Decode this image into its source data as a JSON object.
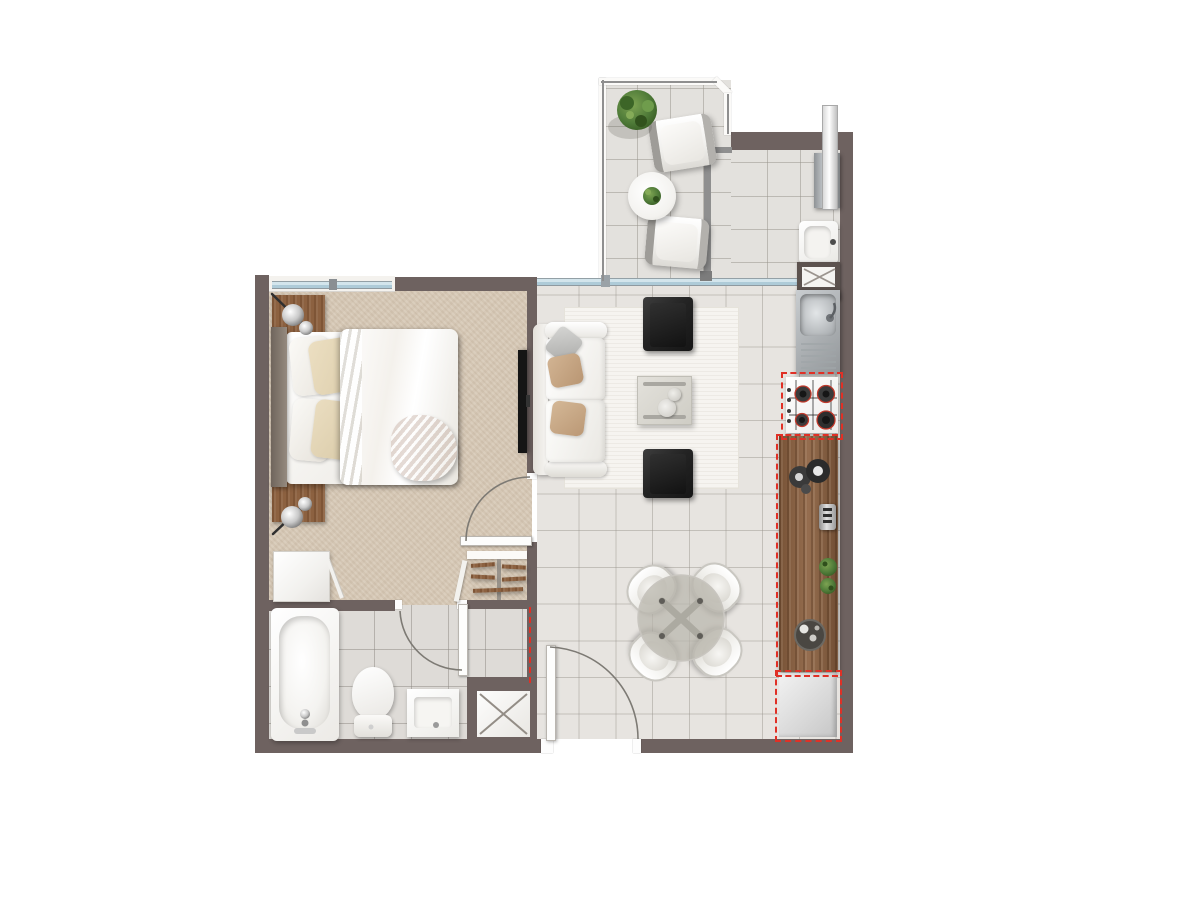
{
  "scene": {
    "type": "apartment-floor-plan",
    "visible_text": "none",
    "rooms": [
      {
        "name": "bedroom"
      },
      {
        "name": "bathroom"
      },
      {
        "name": "living-dining-room"
      },
      {
        "name": "kitchen-strip"
      },
      {
        "name": "balcony-terrace"
      },
      {
        "name": "laundry-terrace"
      },
      {
        "name": "hall-nook"
      }
    ],
    "furniture": [
      "double-bed",
      "nightstand-with-lamp-x2",
      "dresser",
      "open-closet-with-hangers",
      "wall-tv",
      "sofa",
      "armchair-black-x2",
      "coffee-table",
      "rug",
      "dining-table-round-glass",
      "dining-chair-x4",
      "bathtub",
      "toilet",
      "washbasin",
      "duct-shaft",
      "kitchen-sink-with-drainboard",
      "gas-cooktop-4-burner",
      "wood-counter",
      "fridge-space-dashed",
      "laundry-sink",
      "water-heater",
      "appliance-space-crosshatch",
      "balcony-lounge-chair-x2",
      "balcony-round-table",
      "potted-plant"
    ],
    "markers": {
      "red_dashed_outlines": "optional / not-included equipment and openings",
      "door_swing_arcs": 3
    }
  },
  "colors": {
    "wall": "#6e6260",
    "wall_dark": "#5c524e",
    "carpet": "#d7c9b6",
    "tile_living": "#e7e4e0",
    "tile_bath": "#dedbd7",
    "tile_balcony": "#e3e1dd",
    "wood": "#8c6140",
    "rail_gray": "#8f8f8f",
    "red_marker": "#e03026",
    "glass_blue": "#bad4e2",
    "black_chair": "#242424",
    "stainless": "#b5b9bc",
    "rug": "#f6f4f0",
    "glass_table": "#b9b5ac"
  }
}
